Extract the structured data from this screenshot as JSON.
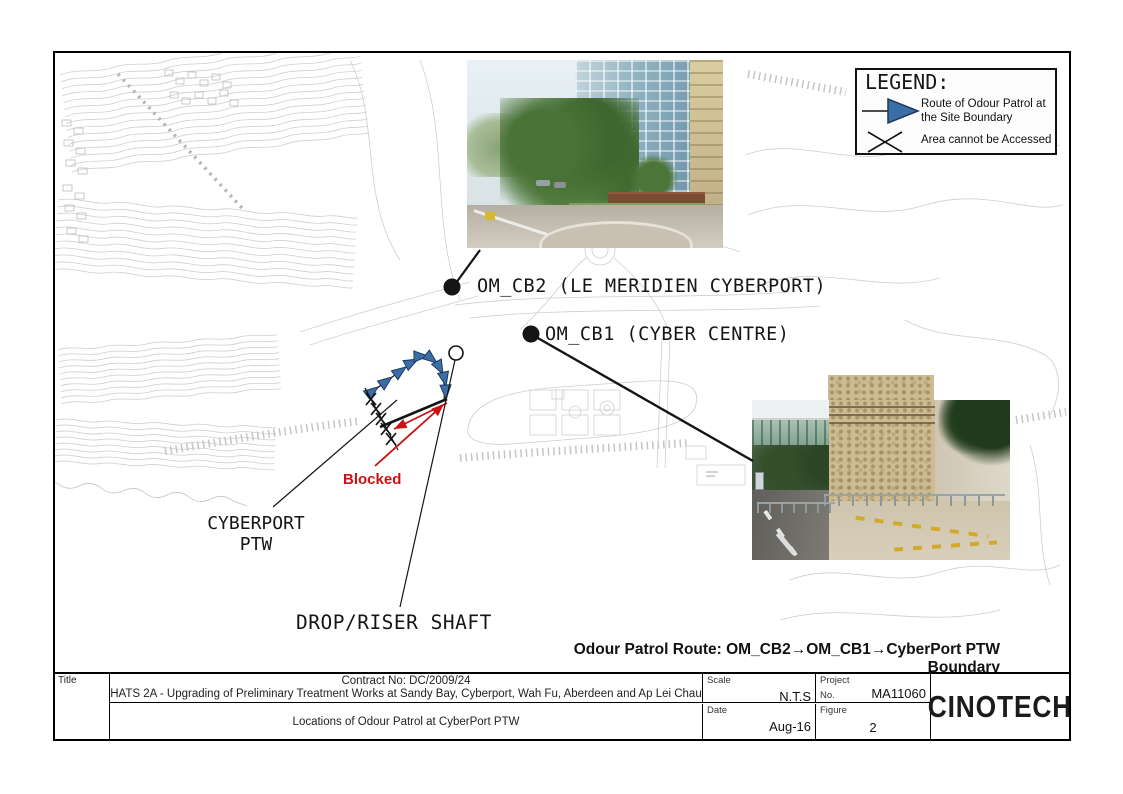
{
  "figure": {
    "legend": {
      "title": "LEGEND:",
      "route_label": "Route of Odour Patrol at the Site Boundary",
      "blocked_label": "Area cannot be Accessed"
    },
    "map_labels": {
      "om_cb2": "OM_CB2 (LE MERIDIEN CYBERPORT)",
      "om_cb1": "OM_CB1 (CYBER CENTRE)",
      "cyberport_ptw_line1": "CYBERPORT",
      "cyberport_ptw_line2": "PTW",
      "drop_riser_shaft": "DROP/RISER SHAFT",
      "blocked": "Blocked"
    },
    "route_note": "Odour Patrol Route: OM_CB2→OM_CB1→CyberPort PTW Boundary"
  },
  "title_block": {
    "title_label": "Title",
    "contract": "Contract No: DC/2009/24",
    "contract_title": "HATS 2A - Upgrading of Preliminary Treatment Works at Sandy Bay, Cyberport, Wah Fu, Aberdeen and Ap Lei Chau",
    "drawing_title": "Locations of Odour Patrol at CyberPort PTW",
    "scale_label": "Scale",
    "scale_value": "N.T.S",
    "project_label": "Project",
    "project_no_label": "No.",
    "project_value": "MA11060",
    "date_label": "Date",
    "date_value": "Aug-16",
    "figure_label": "Figure",
    "figure_value": "2",
    "company": "CINOTECH"
  },
  "colors": {
    "route_blue": "#3A6EA5",
    "route_blue_outline": "#1E3A5F",
    "blocked_red": "#CC1111",
    "line_black": "#141414",
    "map_line": "#c9c9c9"
  }
}
